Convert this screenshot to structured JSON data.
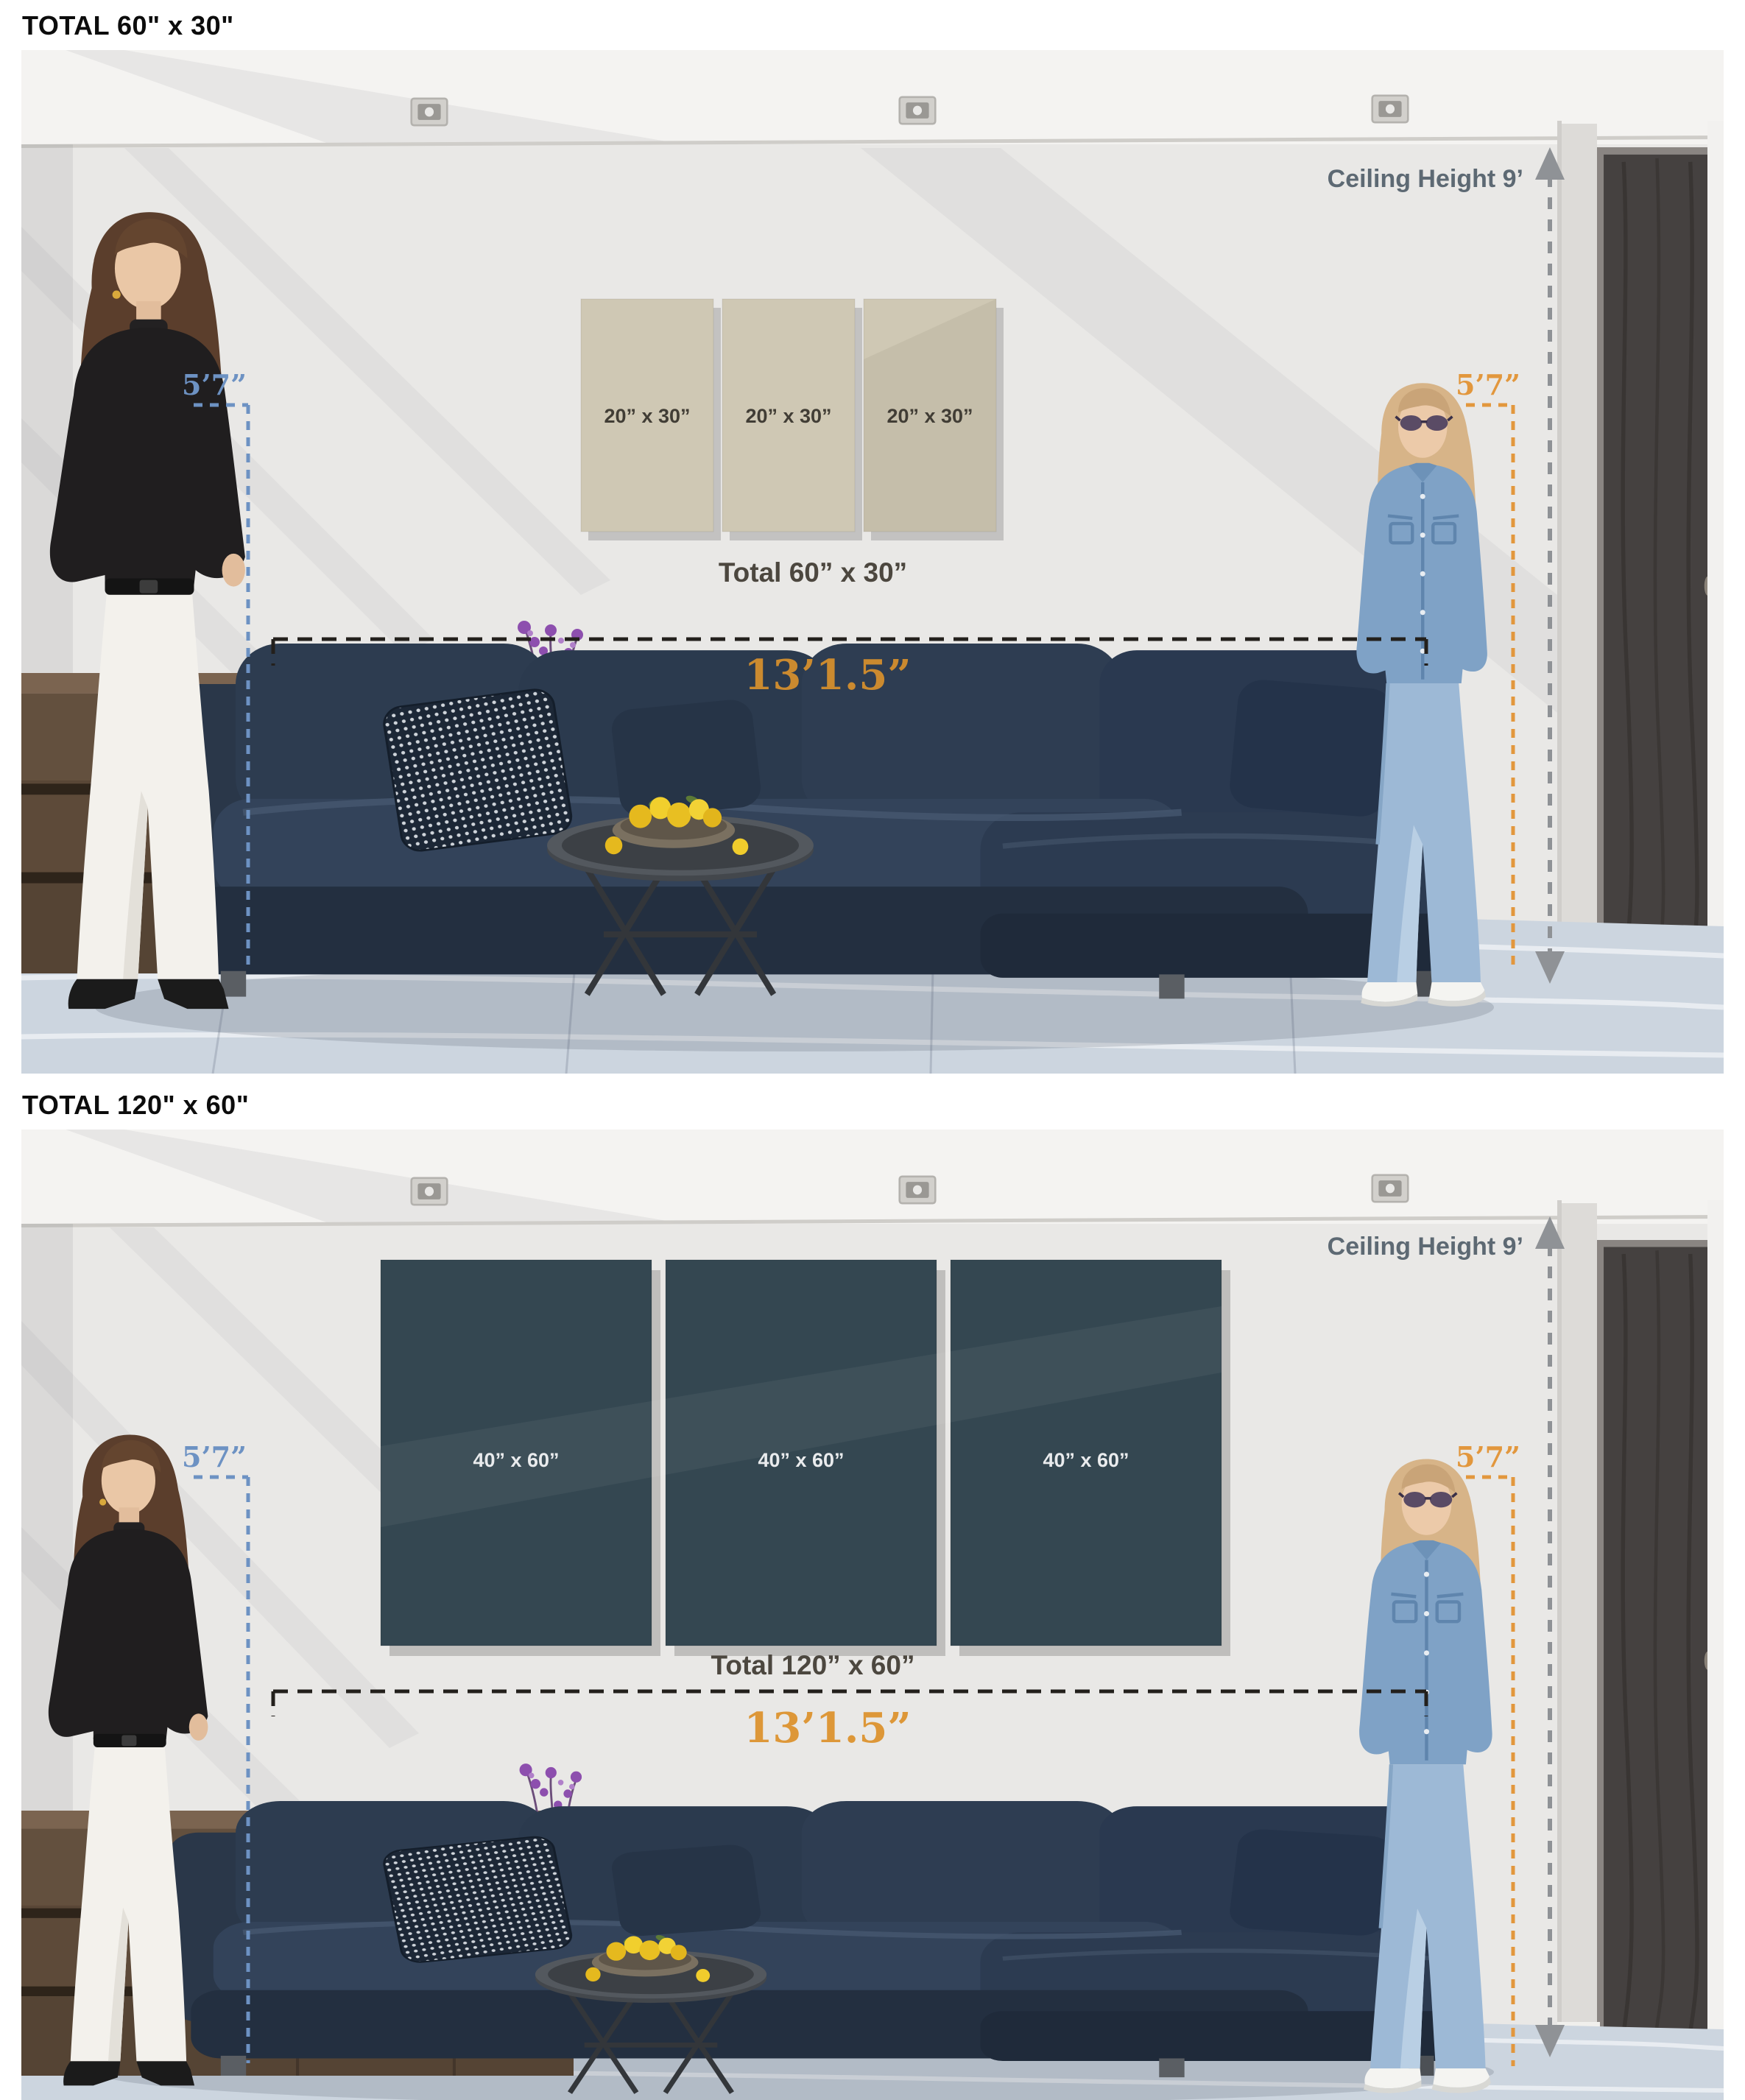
{
  "sections": [
    {
      "title": "TOTAL 60\" x 30\"",
      "canvas_count": 3,
      "canvas_label": "20” x 30”",
      "total_label": "Total 60” x 30”",
      "wall_width": "13’1.5”",
      "left_person_height": "5’7”",
      "right_person_height": "5’7”",
      "ceiling_height": "Ceiling Height 9’",
      "canvas_color": "#cfc8b4",
      "canvas_label_color": "#413d35",
      "dimension_color": "#cb8a2f"
    },
    {
      "title": "TOTAL 120\" x 60\"",
      "canvas_count": 3,
      "canvas_label": "40” x 60”",
      "total_label": "Total 120” x 60”",
      "wall_width": "13’1.5”",
      "left_person_height": "5’7”",
      "right_person_height": "5’7”",
      "ceiling_height": "Ceiling Height 9’",
      "canvas_color": "#344751",
      "canvas_label_color": "#e9ebed",
      "dimension_color": "#dd9738"
    }
  ],
  "colors": {
    "wall": "#e9e8e6",
    "ceiling": "#f4f3f1",
    "floor": "#ccd5df",
    "sofa": "#2c3a4e",
    "door": "#454140",
    "left_marker_blue": "#6d92c3",
    "right_marker_orange": "#e2973d",
    "ceiling_line_gray": "#8f9296",
    "dimension_line_black": "#23201c"
  }
}
